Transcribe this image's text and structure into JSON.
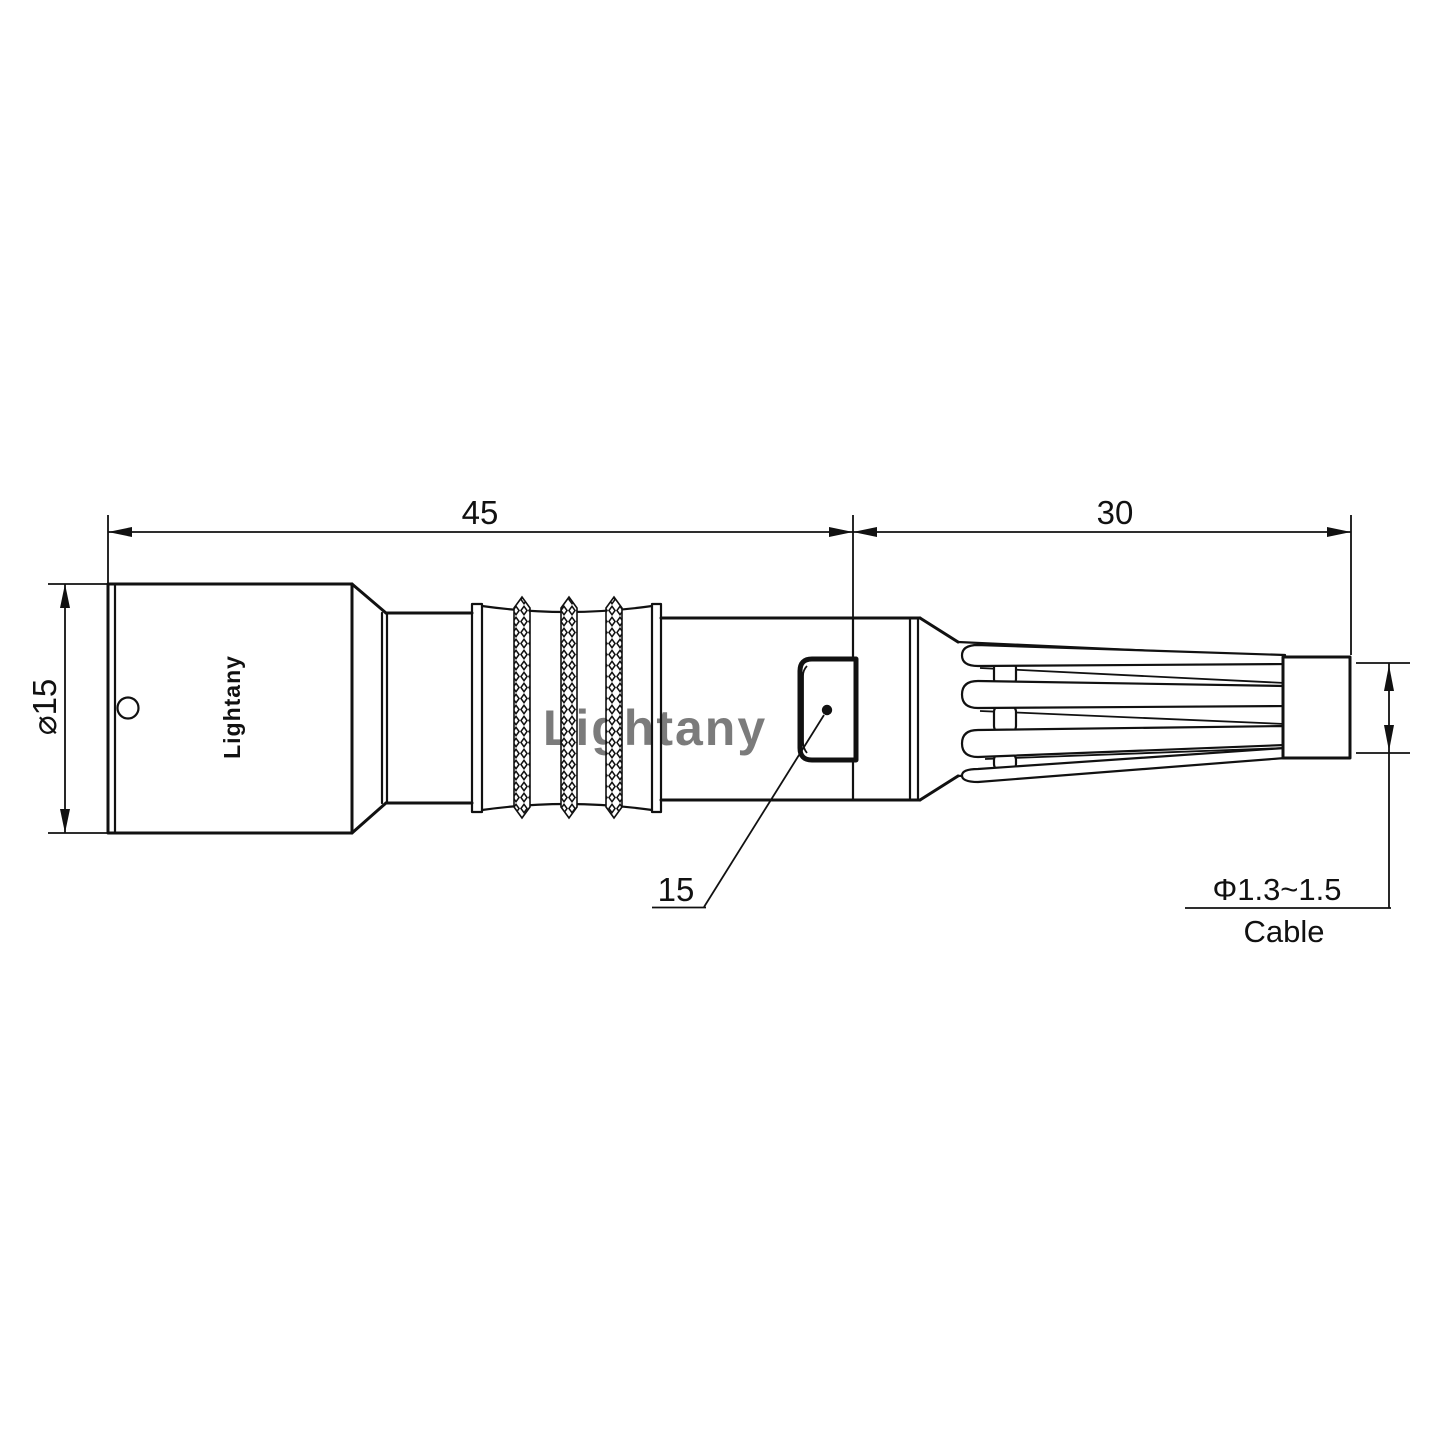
{
  "page": {
    "background": "#ffffff"
  },
  "colors": {
    "line": "#111111",
    "watermark_pink": "#edaaaa"
  },
  "watermark": {
    "text": "Lightany"
  },
  "connector": {
    "brand_label": "Lightany"
  },
  "dimensions": {
    "front_section_length": "45",
    "rear_section_length": "30",
    "body_diameter": "⌀15",
    "latch_callout": "15",
    "cable_diameter_range": "Φ1.3~1.5",
    "cable_label": "Cable"
  }
}
